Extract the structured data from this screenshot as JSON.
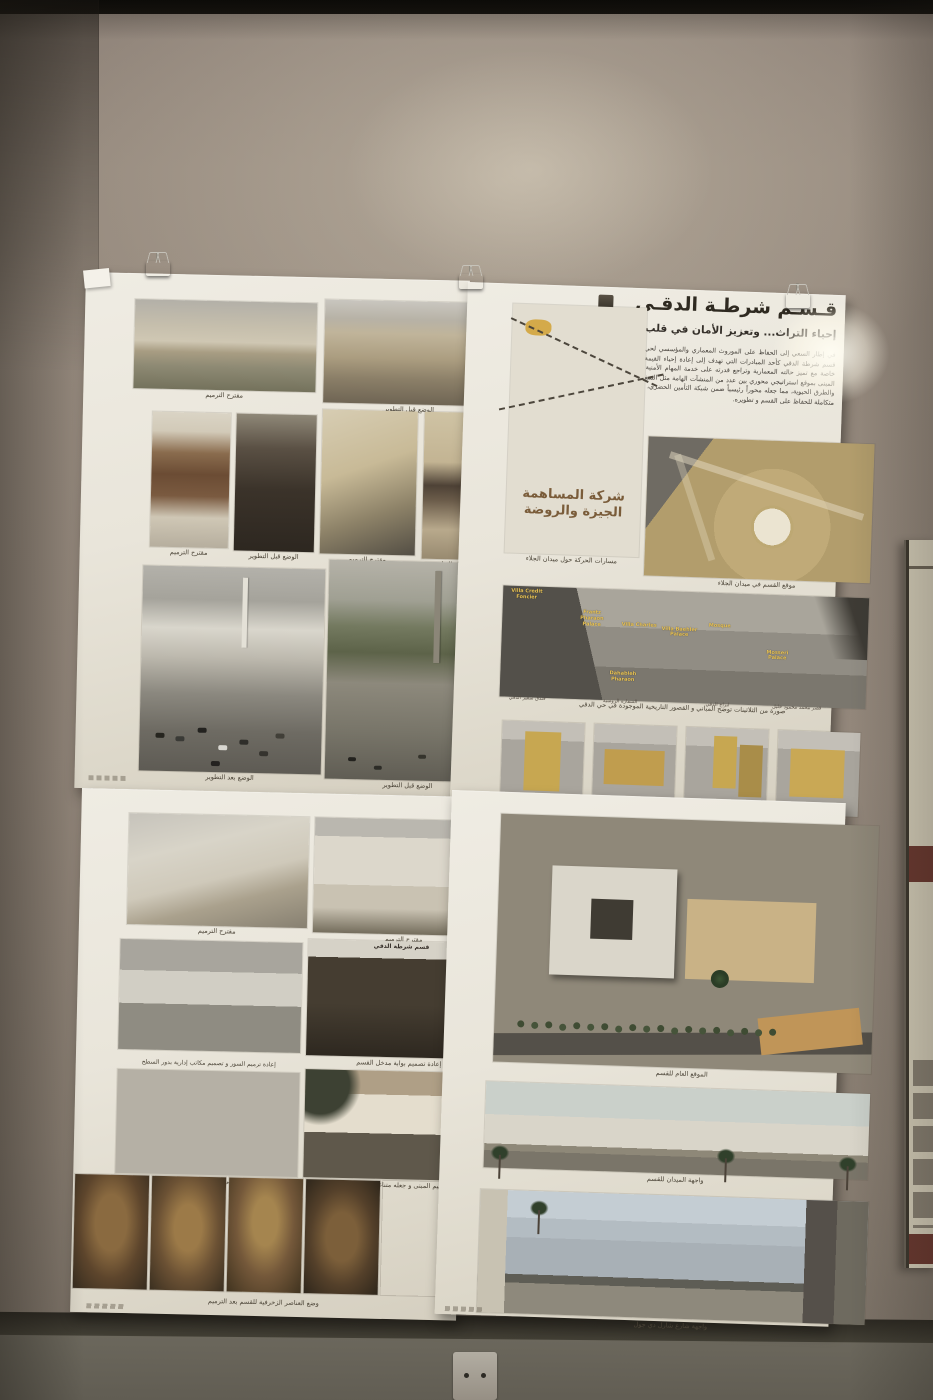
{
  "poster_top_left": {
    "figures": [
      {
        "caption": "مقترح الترميم"
      },
      {
        "caption": "الوضع قبل التطوير"
      },
      {
        "caption": "مقترح الترميم"
      },
      {
        "caption": "الوضع قبل التطوير"
      },
      {
        "caption": "مقترح الترميم"
      },
      {
        "caption": "الوضع قبل التطوير"
      },
      {
        "caption": "الوضع بعد التطوير"
      },
      {
        "caption": "الوضع قبل التطوير"
      }
    ]
  },
  "poster_top_right": {
    "title": "قـسـم شرطـة الدقـي",
    "subtitle": "إحياء التراث... وتعزيز الأمان في قلب الدقي",
    "body": "في إطار السعي إلى الحفاظ على الموروث المعماري والمؤسسي لحي الدقي، جاء مشروع تطوير قسم شرطة الدقي كأحد المبادرات التي تهدف إلى إعادة إحياء القيمة الرمزية والوظيفية للمبنى، خاصة مع تميز حالته المعمارية وتراجع قدرته على خدمة المهام الأمنية الحيوية في المنطقة. يتميز المبنى بموقع استراتيجي محوري بين عدد من المنشآت الهامة مثل السفارات والمؤسسات الحكومية والطرق الحيوية، مما جعله محوراً رئيسياً ضمن شبكة التأمين الحضري، لذلك تم وضع رؤية تصميمية متكاملة للحفاظ على القسم و تطويره.",
    "map_calligraphy_1": "شركة المساهمة",
    "map_calligraphy_2": "الجيزة والروضة",
    "figures": [
      {
        "caption": "مسارات الحركة حول ميدان الجلاء"
      },
      {
        "caption": "موقع القسم في ميدان الجلاء"
      },
      {
        "caption": "صورة من الثلاثينات توضح المباني و القصور التاريخية الموجودة في حي الدقي"
      },
      {
        "caption": "صور من القرن ال ٢١ توضح المباني الهامة الموجودة في حي الدقي"
      }
    ],
    "pano_labels": [
      "Villa Credit Foncier",
      "Frantz Pharaon Palace",
      "Villa Charles",
      "Villa Baehler Palace",
      "Mosque",
      "Mosseri Palace",
      "Dahabieh Pharaon"
    ],
    "strip_labels": [
      "فندق سفير الدقي",
      "السفارة الروسية",
      "أبراج الدقي",
      "قصر محمد محمود خليل"
    ]
  },
  "poster_bottom_left": {
    "gate_sign": "قسم شرطة الدقي",
    "figures": [
      {
        "caption": "مقترح الترميم"
      },
      {
        "caption": "مقترح الترميم"
      },
      {
        "caption": "إعادة ترميم السور و تصميم مكاتب إدارية بدور السطح"
      },
      {
        "caption": "إعادة تصميم بوابة مدخل القسم"
      },
      {
        "caption": "ترميم المبنى و جعله متناغم مع السياق"
      },
      {
        "caption": "ترميم المبنى و جعله متناغم مع السياق"
      },
      {
        "caption": "وضع العناصر الزخرفية للقسم بعد الترميم"
      }
    ]
  },
  "poster_bottom_right": {
    "figures": [
      {
        "caption": "الموقع العام للقسم"
      },
      {
        "caption": "واجهة الميدان للقسم"
      },
      {
        "caption": "واجهة شارع شارل دي جول"
      }
    ]
  }
}
